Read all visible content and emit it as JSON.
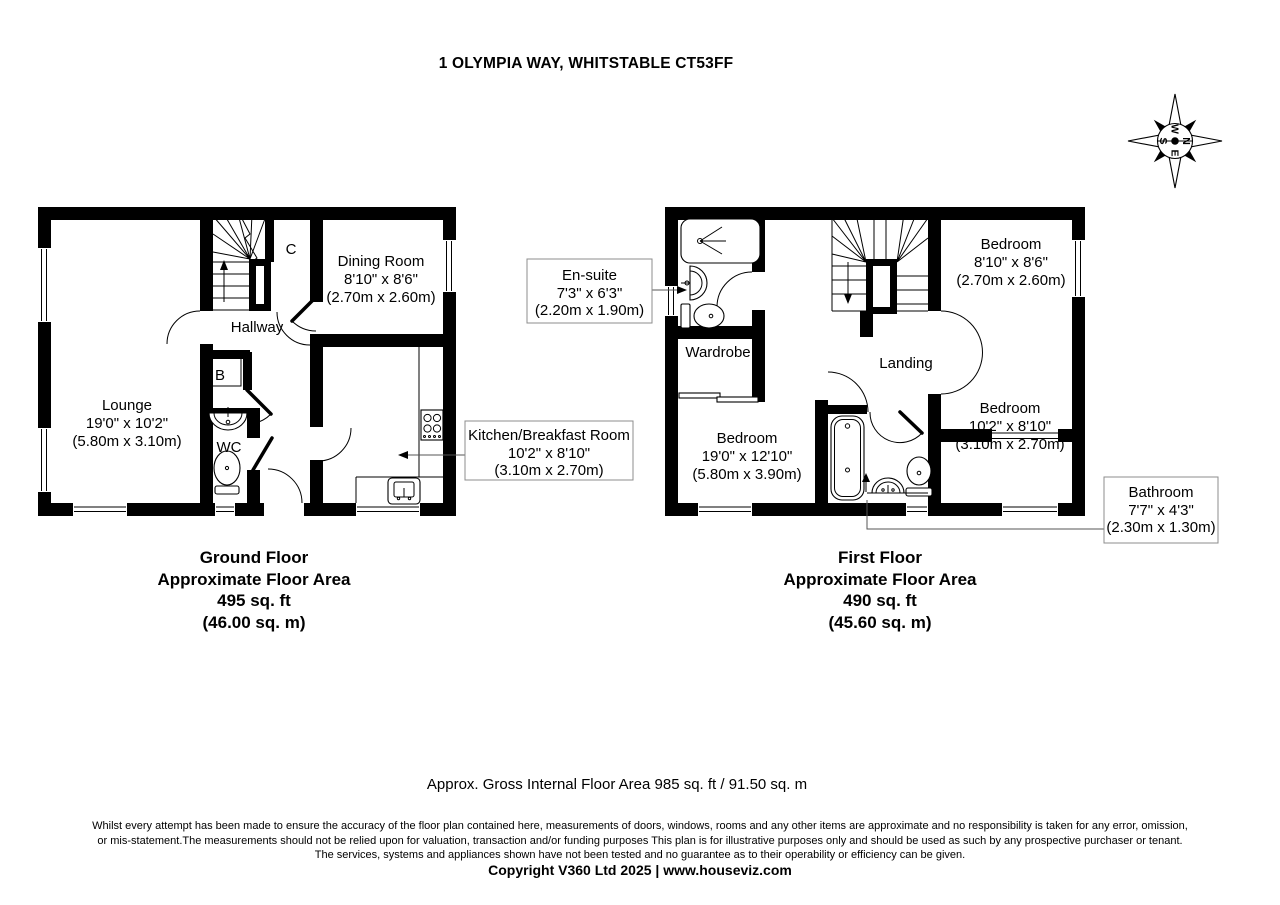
{
  "header": {
    "title": "1 OLYMPIA WAY, WHITSTABLE CT53FF"
  },
  "compass": {
    "n": "N",
    "e": "E",
    "s": "S",
    "w": "W"
  },
  "gf": {
    "lounge": {
      "name": "Lounge",
      "dims_imperial": "19'0\" x 10'2\"",
      "dims_metric": "(5.80m x 3.10m)"
    },
    "hallway": {
      "name": "Hallway"
    },
    "dining": {
      "name": "Dining Room",
      "dims_imperial": "8'10\" x 8'6\"",
      "dims_metric": "(2.70m x 2.60m)"
    },
    "wc": {
      "name": "WC"
    },
    "b": {
      "name": "B"
    },
    "c": {
      "name": "C"
    },
    "kitchen": {
      "name": "Kitchen/Breakfast Room",
      "dims_imperial": "10'2\" x 8'10\"",
      "dims_metric": "(3.10m x 2.70m)"
    },
    "summary": {
      "floor": "Ground Floor",
      "label": "Approximate Floor Area",
      "area_ft": "495 sq. ft",
      "area_m": "(46.00 sq. m)"
    }
  },
  "ff": {
    "bed_top_right": {
      "name": "Bedroom",
      "dims_imperial": "8'10\" x 8'6\"",
      "dims_metric": "(2.70m x 2.60m)"
    },
    "bed_bottom_right": {
      "name": "Bedroom",
      "dims_imperial": "10'2\" x 8'10\"",
      "dims_metric": "(3.10m x 2.70m)"
    },
    "bed_left": {
      "name": "Bedroom",
      "dims_imperial": "19'0\" x 12'10\"",
      "dims_metric": "(5.80m x 3.90m)"
    },
    "landing": {
      "name": "Landing"
    },
    "wardrobe": {
      "name": "Wardrobe"
    },
    "ensuite": {
      "name": "En-suite",
      "dims_imperial": "7'3\" x 6'3\"",
      "dims_metric": "(2.20m x 1.90m)"
    },
    "bathroom": {
      "name": "Bathroom",
      "dims_imperial": "7'7\" x 4'3\"",
      "dims_metric": "(2.30m x 1.30m)"
    },
    "summary": {
      "floor": "First Floor",
      "label": "Approximate Floor Area",
      "area_ft": "490 sq. ft",
      "area_m": "(45.60 sq. m)"
    }
  },
  "footer": {
    "gross": "Approx. Gross Internal Floor Area 985 sq. ft / 91.50 sq. m",
    "disc": [
      "Whilst every attempt has been made to ensure the accuracy of the floor plan contained here, measurements of doors, windows, rooms and any other items are approximate and no responsibility is taken for any error, omission,",
      "or mis-statement.The measurements should not be relied upon for valuation, transaction and/or funding purposes This plan is for illustrative purposes only and should be used as such by any prospective purchaser or tenant.",
      "The services, systems and appliances shown have not been tested and no guarantee as to their operability or efficiency can be given."
    ],
    "copyright": "Copyright V360 Ltd 2025 | www.houseviz.com"
  }
}
